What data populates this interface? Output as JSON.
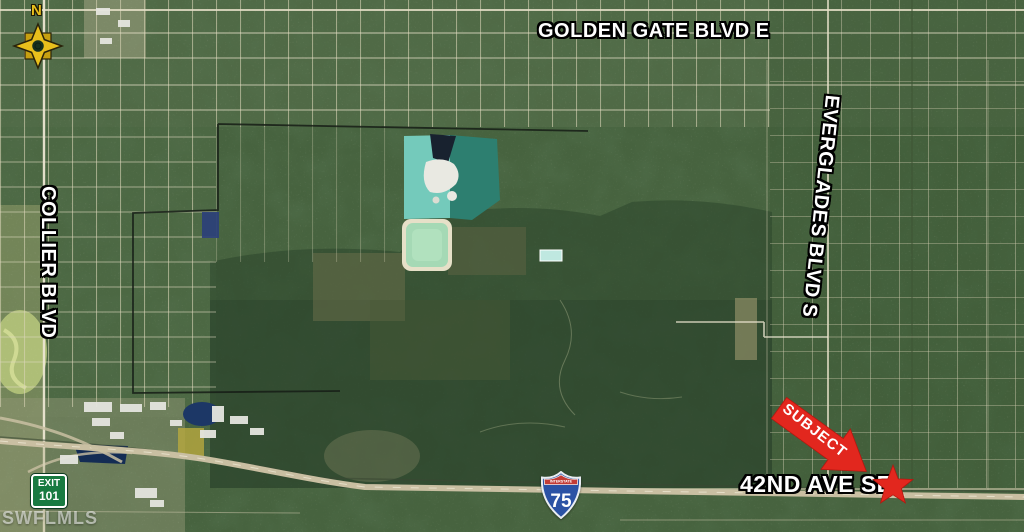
{
  "map": {
    "road_labels": {
      "golden_gate": "GOLDEN GATE BLVD E",
      "collier": "COLLIER BLVD",
      "everglades": "EVERGLADES BLVD S",
      "forty_second_ave": "42ND AVE SE"
    },
    "subject_marker": {
      "label": "SUBJECT"
    },
    "compass": {
      "north_label": "N"
    },
    "interstate_shield": {
      "header": "INTERSTATE",
      "route_number": "75"
    },
    "exit_sign": {
      "line1": "EXIT",
      "line2": "101"
    },
    "watermark": "SWFLMLS",
    "colors": {
      "marker_red": "#e2271e",
      "label_white": "#ffffff",
      "exit_sign_green": "#187a41",
      "shield_blue": "#2b52a5",
      "shield_red": "#c33b36",
      "compass_gold": "#e8bf1c",
      "quarry_teal_light": "#74cabb",
      "quarry_teal_dark": "#2d7f70",
      "pond_pale_green": "#a5d9b5",
      "base_vegetation_green": "#47633f"
    }
  }
}
